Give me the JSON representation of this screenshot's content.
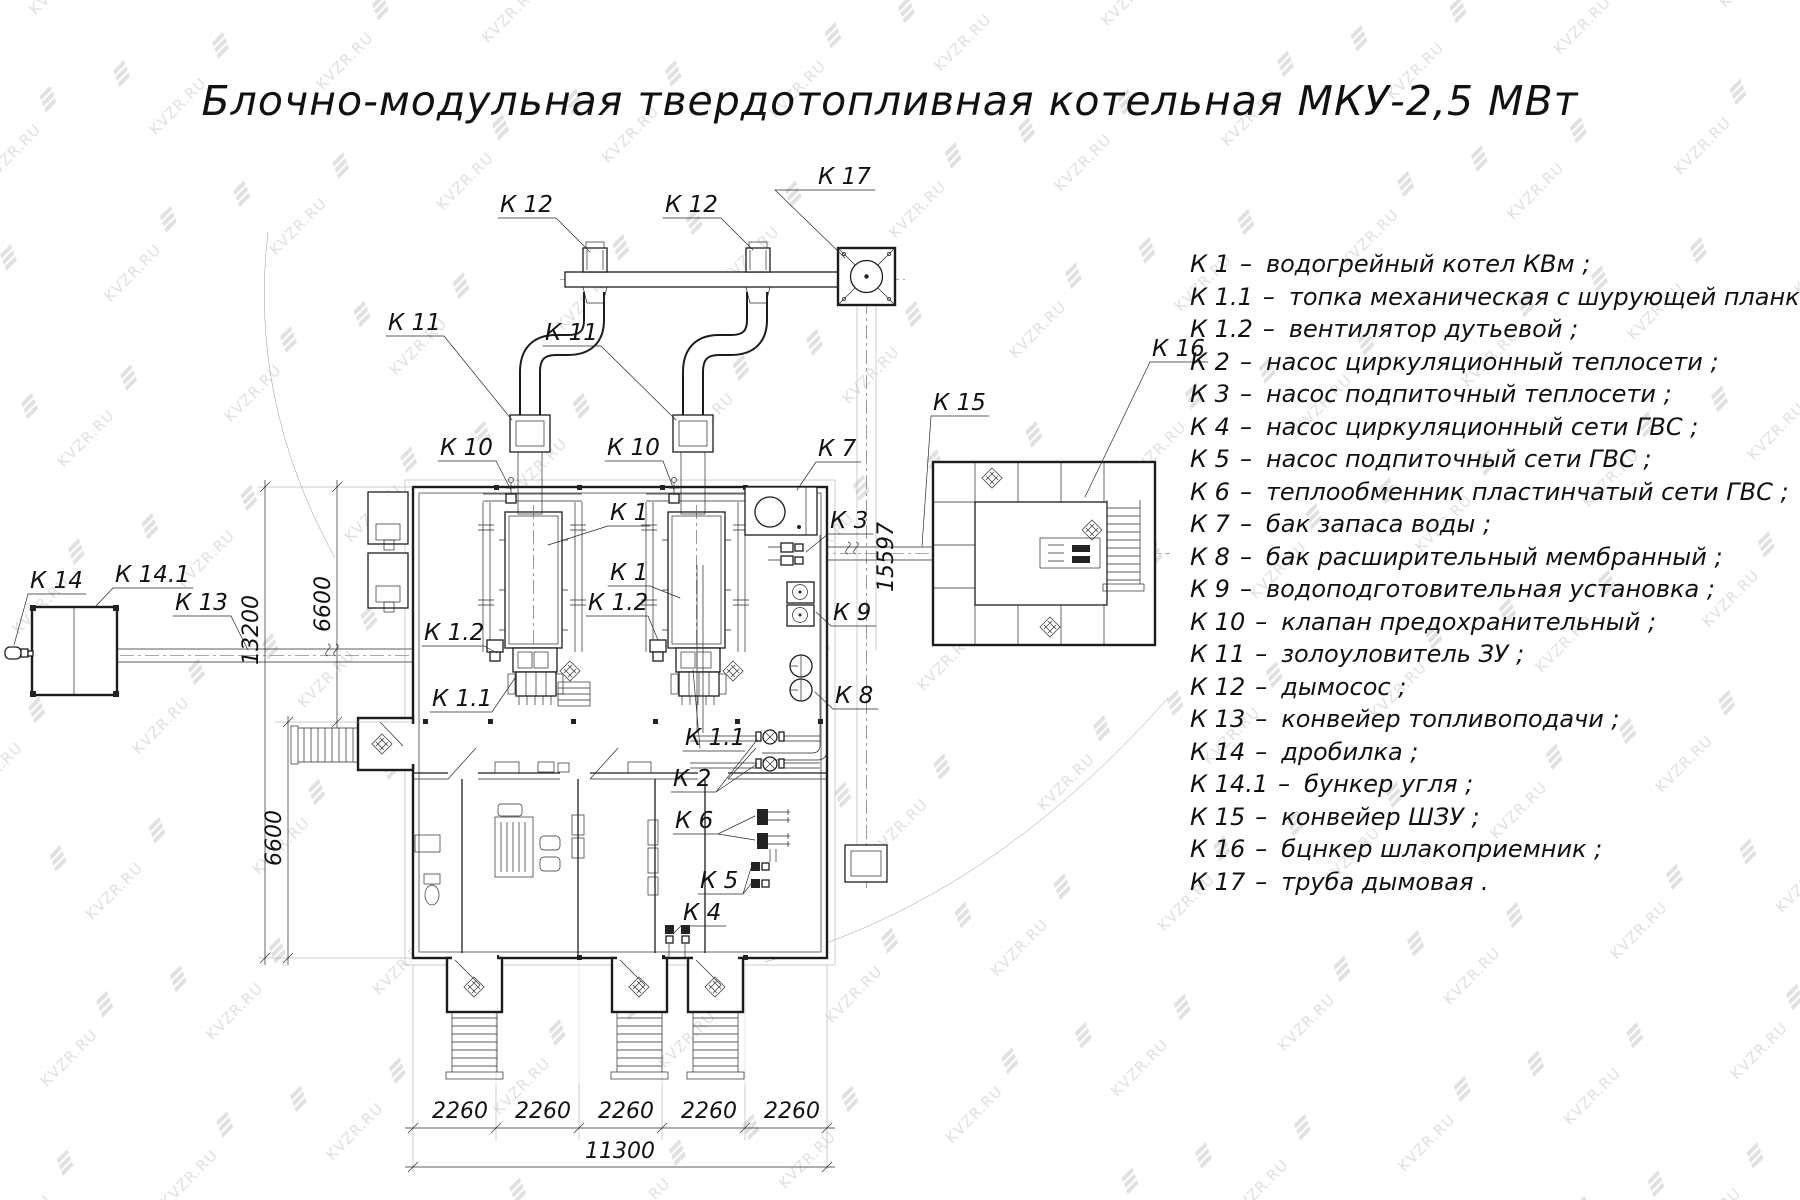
{
  "title": "Блочно-модульная твердотопливная котельная МКУ-2,5  МВт",
  "watermark": "KVZR.RU",
  "legend": {
    "separator": "–",
    "items": [
      {
        "code": "К 1",
        "desc": "водогрейный котел КВм ;"
      },
      {
        "code": "К 1.1",
        "desc": "топка механическая с шурующей планкой ;"
      },
      {
        "code": "К 1.2",
        "desc": "вентилятор дутьевой ;"
      },
      {
        "code": "К 2",
        "desc": "насос циркуляционный теплосети ;"
      },
      {
        "code": "К 3",
        "desc": "насос подпиточный теплосети ;"
      },
      {
        "code": "К 4",
        "desc": "насос циркуляционный сети ГВС ;"
      },
      {
        "code": "К 5",
        "desc": "насос подпиточный сети ГВС ;"
      },
      {
        "code": "К 6",
        "desc": "теплообменник пластинчатый сети ГВС ;"
      },
      {
        "code": "К 7",
        "desc": "бак запаса воды ;"
      },
      {
        "code": "К 8",
        "desc": "бак расширительный мембранный ;"
      },
      {
        "code": "К 9",
        "desc": "водоподготовительная установка ;"
      },
      {
        "code": "К 10",
        "desc": "клапан предохранительный ;"
      },
      {
        "code": "К 11",
        "desc": "золоуловитель ЗУ ;"
      },
      {
        "code": "К 12",
        "desc": "дымосос ;"
      },
      {
        "code": "К 13",
        "desc": "конвейер топливоподачи ;"
      },
      {
        "code": "К 14",
        "desc": "дробилка ;"
      },
      {
        "code": "К 14.1",
        "desc": "бункер угля ;"
      },
      {
        "code": "К 15",
        "desc": "конвейер ШЗУ ;"
      },
      {
        "code": "К 16",
        "desc": "бцнкер шлакоприемник ;"
      },
      {
        "code": "К 17",
        "desc": "труба дымовая ."
      }
    ]
  },
  "plan_labels": {
    "k1": "К 1",
    "k1_1": "К 1.1",
    "k1_2": "К 1.2",
    "k2": "К 2",
    "k3": "К 3",
    "k4": "К 4",
    "k5": "К 5",
    "k6": "К 6",
    "k7": "К 7",
    "k8": "К 8",
    "k9": "К 9",
    "k10": "К 10",
    "k11": "К 11",
    "k12": "К 12",
    "k13": "К 13",
    "k14": "К 14",
    "k14_1": "К 14.1",
    "k15": "К 15",
    "k16": "К 16",
    "k17": "К 17"
  },
  "dimensions": {
    "bottom_segments": [
      "2260",
      "2260",
      "2260",
      "2260",
      "2260"
    ],
    "bottom_total": "11300",
    "left_upper": "6600",
    "left_lower": "6600",
    "left_total": "13200",
    "right": "15597"
  }
}
